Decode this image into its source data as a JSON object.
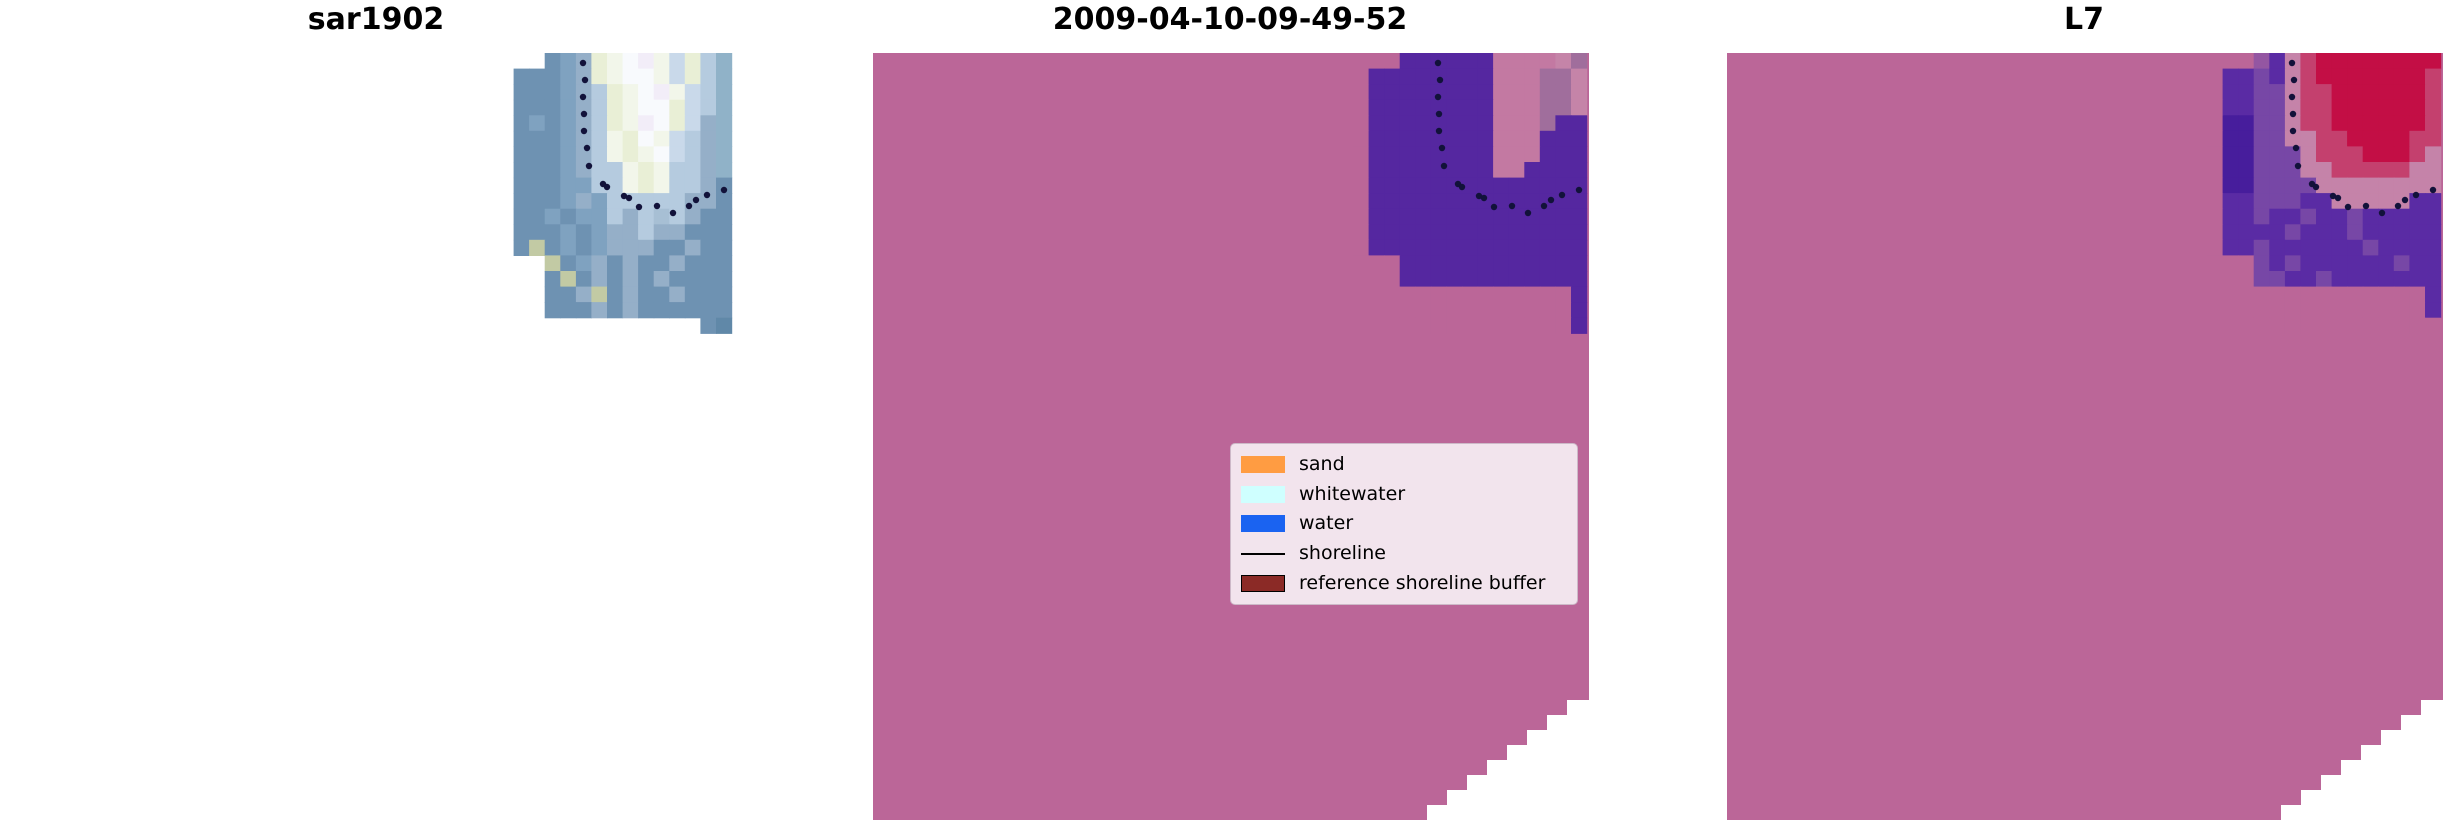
{
  "figure": {
    "width": 2460,
    "height": 834,
    "background": "#ffffff"
  },
  "chart_data": {
    "type": "heatmap",
    "description": "Three-panel satellite shoreline classification figure: SAR image chip, classified scene with legend, and Landsat-7 scene; dotted black shoreline curve drawn on each panel",
    "dot_color": "#12123A",
    "notch_points": "554,767 554,752 574,752 574,737 594,737 594,722 614,722 614,707 634,707 634,692 654,692 654,677 674,677 674,662 694,662 694,647 716,647 716,767",
    "shoreline_dots": [
      [
        565,
        10
      ],
      [
        567,
        27
      ],
      [
        565,
        44
      ],
      [
        566,
        61
      ],
      [
        566,
        78
      ],
      [
        569,
        95
      ],
      [
        571,
        113
      ],
      [
        585,
        131
      ],
      [
        589,
        134
      ],
      [
        606,
        143
      ],
      [
        611,
        145
      ],
      [
        621,
        154
      ],
      [
        639,
        153
      ],
      [
        655,
        160
      ],
      [
        671,
        153
      ],
      [
        678,
        147
      ],
      [
        689,
        142
      ],
      [
        706,
        137
      ]
    ],
    "panels": [
      {
        "title": "sar1902",
        "background": "transparent",
        "show_dots": true,
        "notch": false,
        "grid": {
          "x": 480,
          "y": 0,
          "cell": 15.57,
          "palette": {
            "s": "#6E92B2",
            "S": "#7FA2C0",
            "g": "#95AFC8",
            "b": "#B5CBDF",
            "p": "#C9D9EA",
            "c": "#E9EFD6",
            "w": "#F2F6EA",
            "W": "#F8FAFD",
            "l": "#F2EDF8",
            "t": "#90B2C8",
            "G": "#C2CAA4",
            "d": "#6088A8",
            "e": "#A7BFD4"
          },
          "rows": [
            "...sSgcwWlwpcbt",
            ".sssSgcwWWwpcbt",
            ".sssSgbcwWlwpbt",
            ".sssSgbcwWWcpbt",
            ".sSsSgbcwlWcpgt",
            ".sssSgbwcWwpbgt",
            ".sssSgbwcwWpbgt",
            ".sssSgbbwcwbbgt",
            ".sssSSbbwcwbbgs",
            ".sssSgSbbbbbggs",
            ".ssSsSSbgbebgss",
            ".sssSsSggbggsss",
            ".sGsSsSgggssgss",
            "...GsSgsgssgsss",
            "...sGsgsgsgssss",
            "...ssgGsgssgsss",
            "...sssgsgssssss",
            ".............sd"
          ]
        }
      },
      {
        "title": "2009-04-10-09-49-52",
        "background": "#BB6698",
        "show_dots": true,
        "notch": true,
        "grid": {
          "x": 480,
          "y": 0,
          "cell": 15.57,
          "palette": {
            "B": "#BB6698",
            "P": "#5527A0",
            "K": "#C379A2",
            "M": "#A06E9C",
            "L": "#C584A8"
          },
          "rows": [
            "BBBPPPPPPKKKKLM",
            "BPPPPPPPPKKKMML",
            "BPPPPPPPPKKKMML",
            "BPPPPPPPPKKKMML",
            "BPPPPPPPPKKKMPP",
            "BPPPPPPPPKKKPPP",
            "BPPPPPPPPKKKPPP",
            "BPPPPPPPPKKPPPP",
            "BPPPPPPPPPPPPPP",
            "BPPPPPPPPPPPPPP",
            "BPPPPPPPPPPPPPP",
            "BPPPPPPPPPPPPPP",
            "BPPPPPPPPPPPPPP",
            "BBBPPPPPPPPPPPP",
            "BBBPPPPPPPPPPPP",
            "BBBBBBBBBBBBBBP",
            "BBBBBBBBBBBBBBP",
            "BBBBBBBBBBBBBBP"
          ]
        }
      },
      {
        "title": "L7",
        "background": "#BB6698",
        "show_dots": true,
        "notch": true,
        "grid": {
          "x": 480,
          "y": 0,
          "cell": 15.57,
          "palette": {
            "B": "#BB6698",
            "V": "#5A2BA4",
            "D": "#471D9C",
            "v": "#7747A6",
            "m": "#9456A2",
            "K": "#C583A9",
            "r": "#C4406E",
            "R": "#C30E45"
          },
          "rows": [
            "BBBmVKrRRRRRRRR",
            "BVVvVKrRRRRRRRr",
            "BVVvvKrrRRRRRRr",
            "BVVvvKrrRRRRRRr",
            "BDDvvKrrRRRRRRr",
            "BDDvvKKrrRRRRrr",
            "BDDvvvKrrrRRRrK",
            "BDDvvvKKrrrrrKK",
            "BDDvvvvKKKKKKKK",
            "BVVvvvVVKKKKKVV",
            "BVVvVVvVVvVVVVV",
            "BVVVVvVVVvVVVVV",
            "BVVvVVVVVVvVVVV",
            "BBBvVvVVVVVVvVV",
            "BBBvvVVvVVVVVVV",
            "BBBBBBBBBBBBBBV",
            "BBBBBBBBBBBBBBV",
            "BBBBBBBBBBBBBBB"
          ]
        }
      }
    ],
    "legend": {
      "background": "#F2E4ED",
      "border_color": "#CDB9C8",
      "items": [
        {
          "label": "sand",
          "color": "#FF9C42",
          "kind": "patch"
        },
        {
          "label": "whitewater",
          "color": "#CFFFFF",
          "kind": "patch"
        },
        {
          "label": "water",
          "color": "#1A63F1",
          "kind": "patch"
        },
        {
          "label": "shoreline",
          "color": "#000000",
          "kind": "line"
        },
        {
          "label": "reference shoreline buffer",
          "color": "#8B2A26",
          "kind": "patch-edge"
        }
      ]
    }
  }
}
